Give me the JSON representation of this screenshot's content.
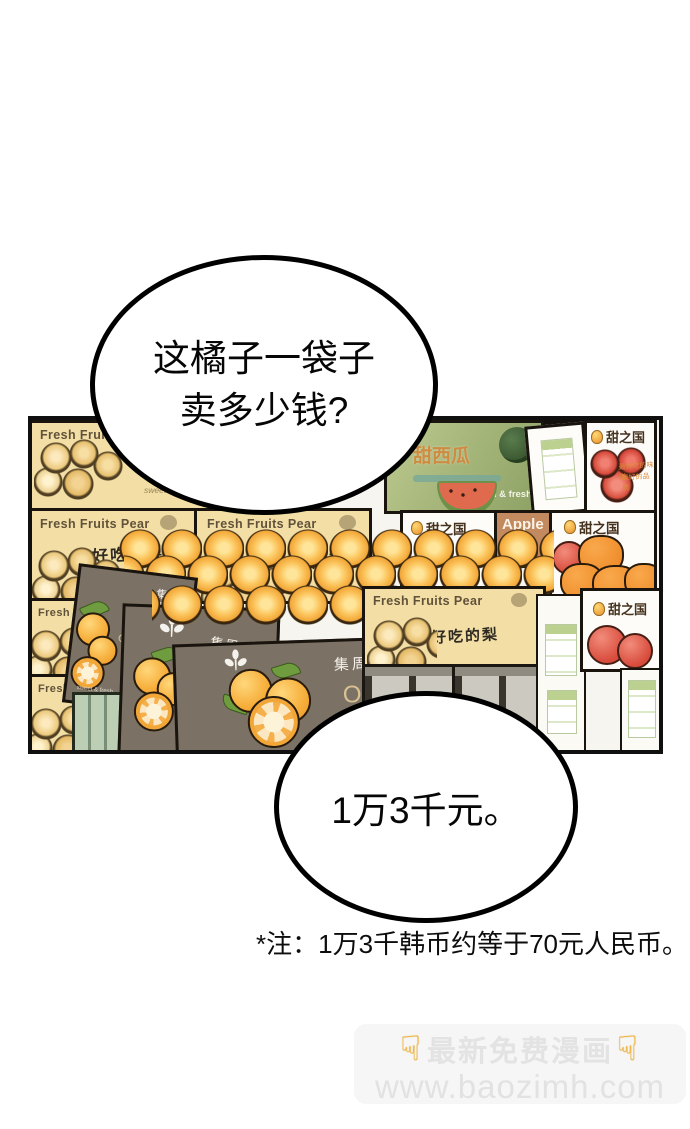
{
  "speech": {
    "question": {
      "line1": "这橘子一袋子",
      "line2": "卖多少钱?"
    },
    "answer": "1万3千元。"
  },
  "footnote": "*注：1万3千韩币约等于70元人民币。",
  "watermark": {
    "hand": "☟",
    "title": "最新免费漫画",
    "url": "www.baozimh.com"
  },
  "market": {
    "pear": {
      "brand": "Fresh Fruits Pear",
      "slogan": "好吃的梨",
      "note": "sweet taste"
    },
    "melon": {
      "brand": "甜西瓜",
      "slogan": "cool & fresh"
    },
    "sweet_kingdom": {
      "brand": "甜之国",
      "line1": "最好吃的味道",
      "line2": "最好的品质"
    },
    "apple": {
      "brand": "Apple",
      "cn": "苹果"
    },
    "orange": {
      "brand": "集周",
      "name": "Orange",
      "slogan": "sweet & fresh"
    }
  },
  "colors": {
    "panel_border": "#101010",
    "bubble_border": "#000000",
    "pear_box": "#f3dfa5",
    "orange_box": "#7b7164",
    "melon_box": "#a9b87d",
    "fruit_orange": "#f2a93c",
    "watermark_text": "#e3e3e3",
    "watermark_hand": "#f3b53a"
  }
}
